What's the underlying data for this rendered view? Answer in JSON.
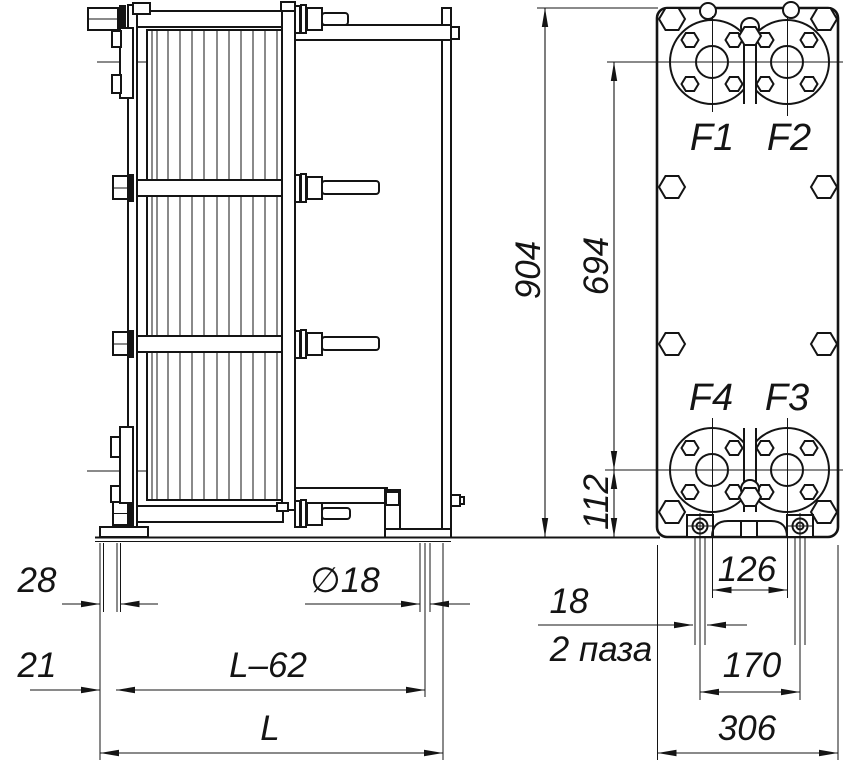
{
  "drawing": {
    "kind": "plate-heat-exchanger-dimensional-drawing",
    "colors": {
      "line": "#141414",
      "background": "#ffffff"
    },
    "ports": {
      "f1": "F1",
      "f2": "F2",
      "f3": "F3",
      "f4": "F4"
    },
    "dimensions": {
      "side_view": {
        "offset_28": "28",
        "offset_21": "21",
        "hole_diameter": "∅18",
        "length_minus_62": "L–62",
        "length_total": "L"
      },
      "front_view": {
        "height_904": "904",
        "port_span_694": "694",
        "bottom_offset_112": "112",
        "feet_inner_126": "126",
        "slot_width_18": "18",
        "slot_note": "2 паза",
        "feet_centers_170": "170",
        "width_306": "306"
      }
    }
  }
}
